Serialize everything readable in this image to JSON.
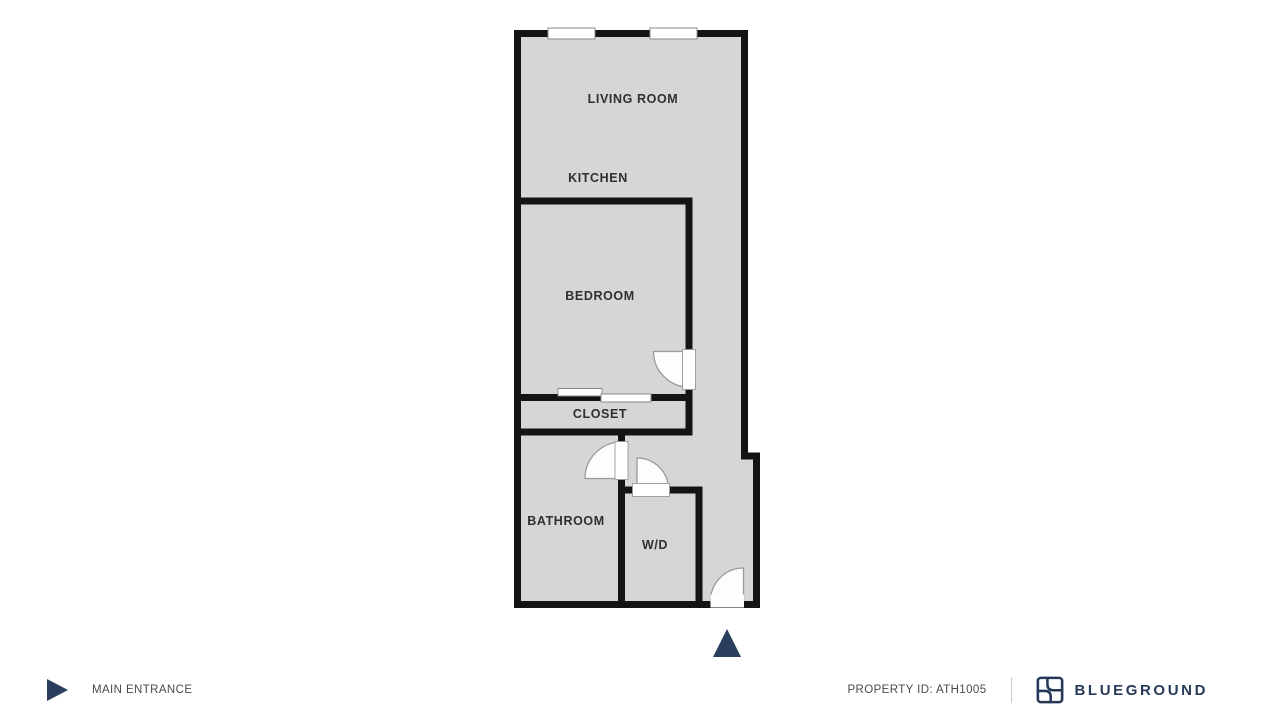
{
  "floor_plan": {
    "rooms": [
      {
        "name": "living-room",
        "label": "LIVING ROOM"
      },
      {
        "name": "kitchen",
        "label": "KITCHEN"
      },
      {
        "name": "bedroom",
        "label": "BEDROOM"
      },
      {
        "name": "closet",
        "label": "CLOSET"
      },
      {
        "name": "bathroom",
        "label": "BATHROOM"
      },
      {
        "name": "wd",
        "label": "W/D"
      }
    ],
    "features": [
      "two windows on top wall",
      "bedroom swing door",
      "closet sliding door",
      "bathroom swing door",
      "wd swing door",
      "main entrance swing door with marker triangle"
    ],
    "colors": {
      "floor": "#d5d6d7",
      "wall": "#141414",
      "door_arc": "#9a9a9a",
      "door_fill": "#fdfdfd",
      "entrance_marker": "#2c3e5d"
    }
  },
  "footer": {
    "main_entrance_label": "MAIN ENTRANCE",
    "property_id_label": "PROPERTY ID: ATH1005",
    "brand": "BLUEGROUND",
    "text_color": "#4a4a4a",
    "brand_color": "#27395a"
  }
}
